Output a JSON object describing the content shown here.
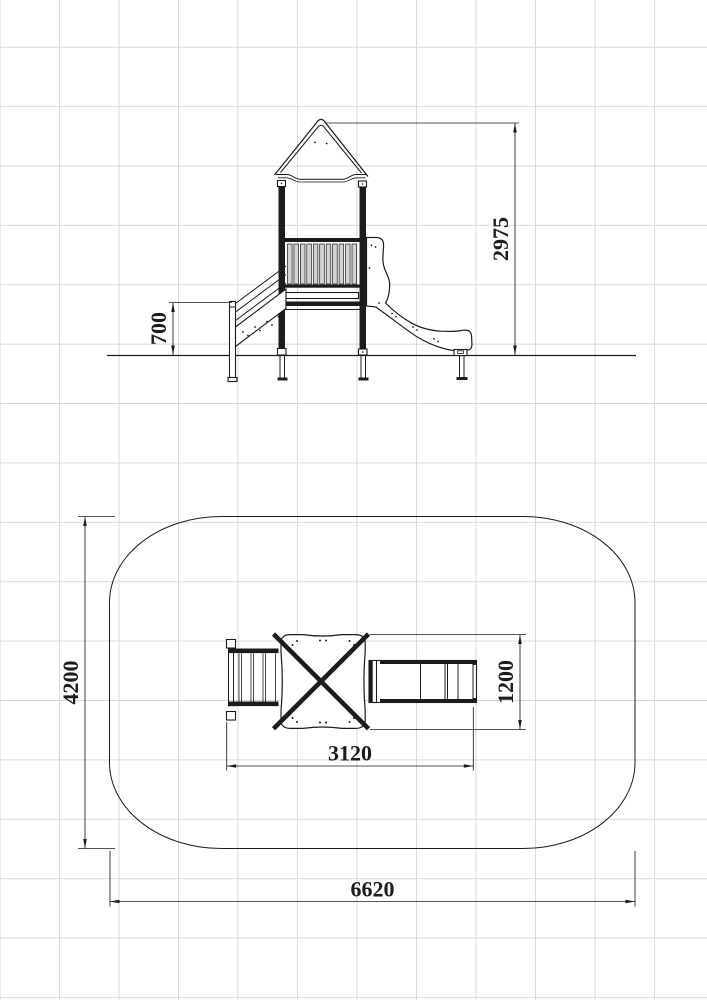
{
  "colors": {
    "background": "#ffffff",
    "grid": "#d9d9d9",
    "line": "#1c1c1c"
  },
  "views": {
    "elevation": {
      "dimensions": {
        "overall_height": "2975",
        "stair_height": "700"
      }
    },
    "plan": {
      "dimensions": {
        "safety_zone_length": "6620",
        "safety_zone_width": "4200",
        "equipment_length": "3120",
        "equipment_width": "1200"
      }
    }
  }
}
